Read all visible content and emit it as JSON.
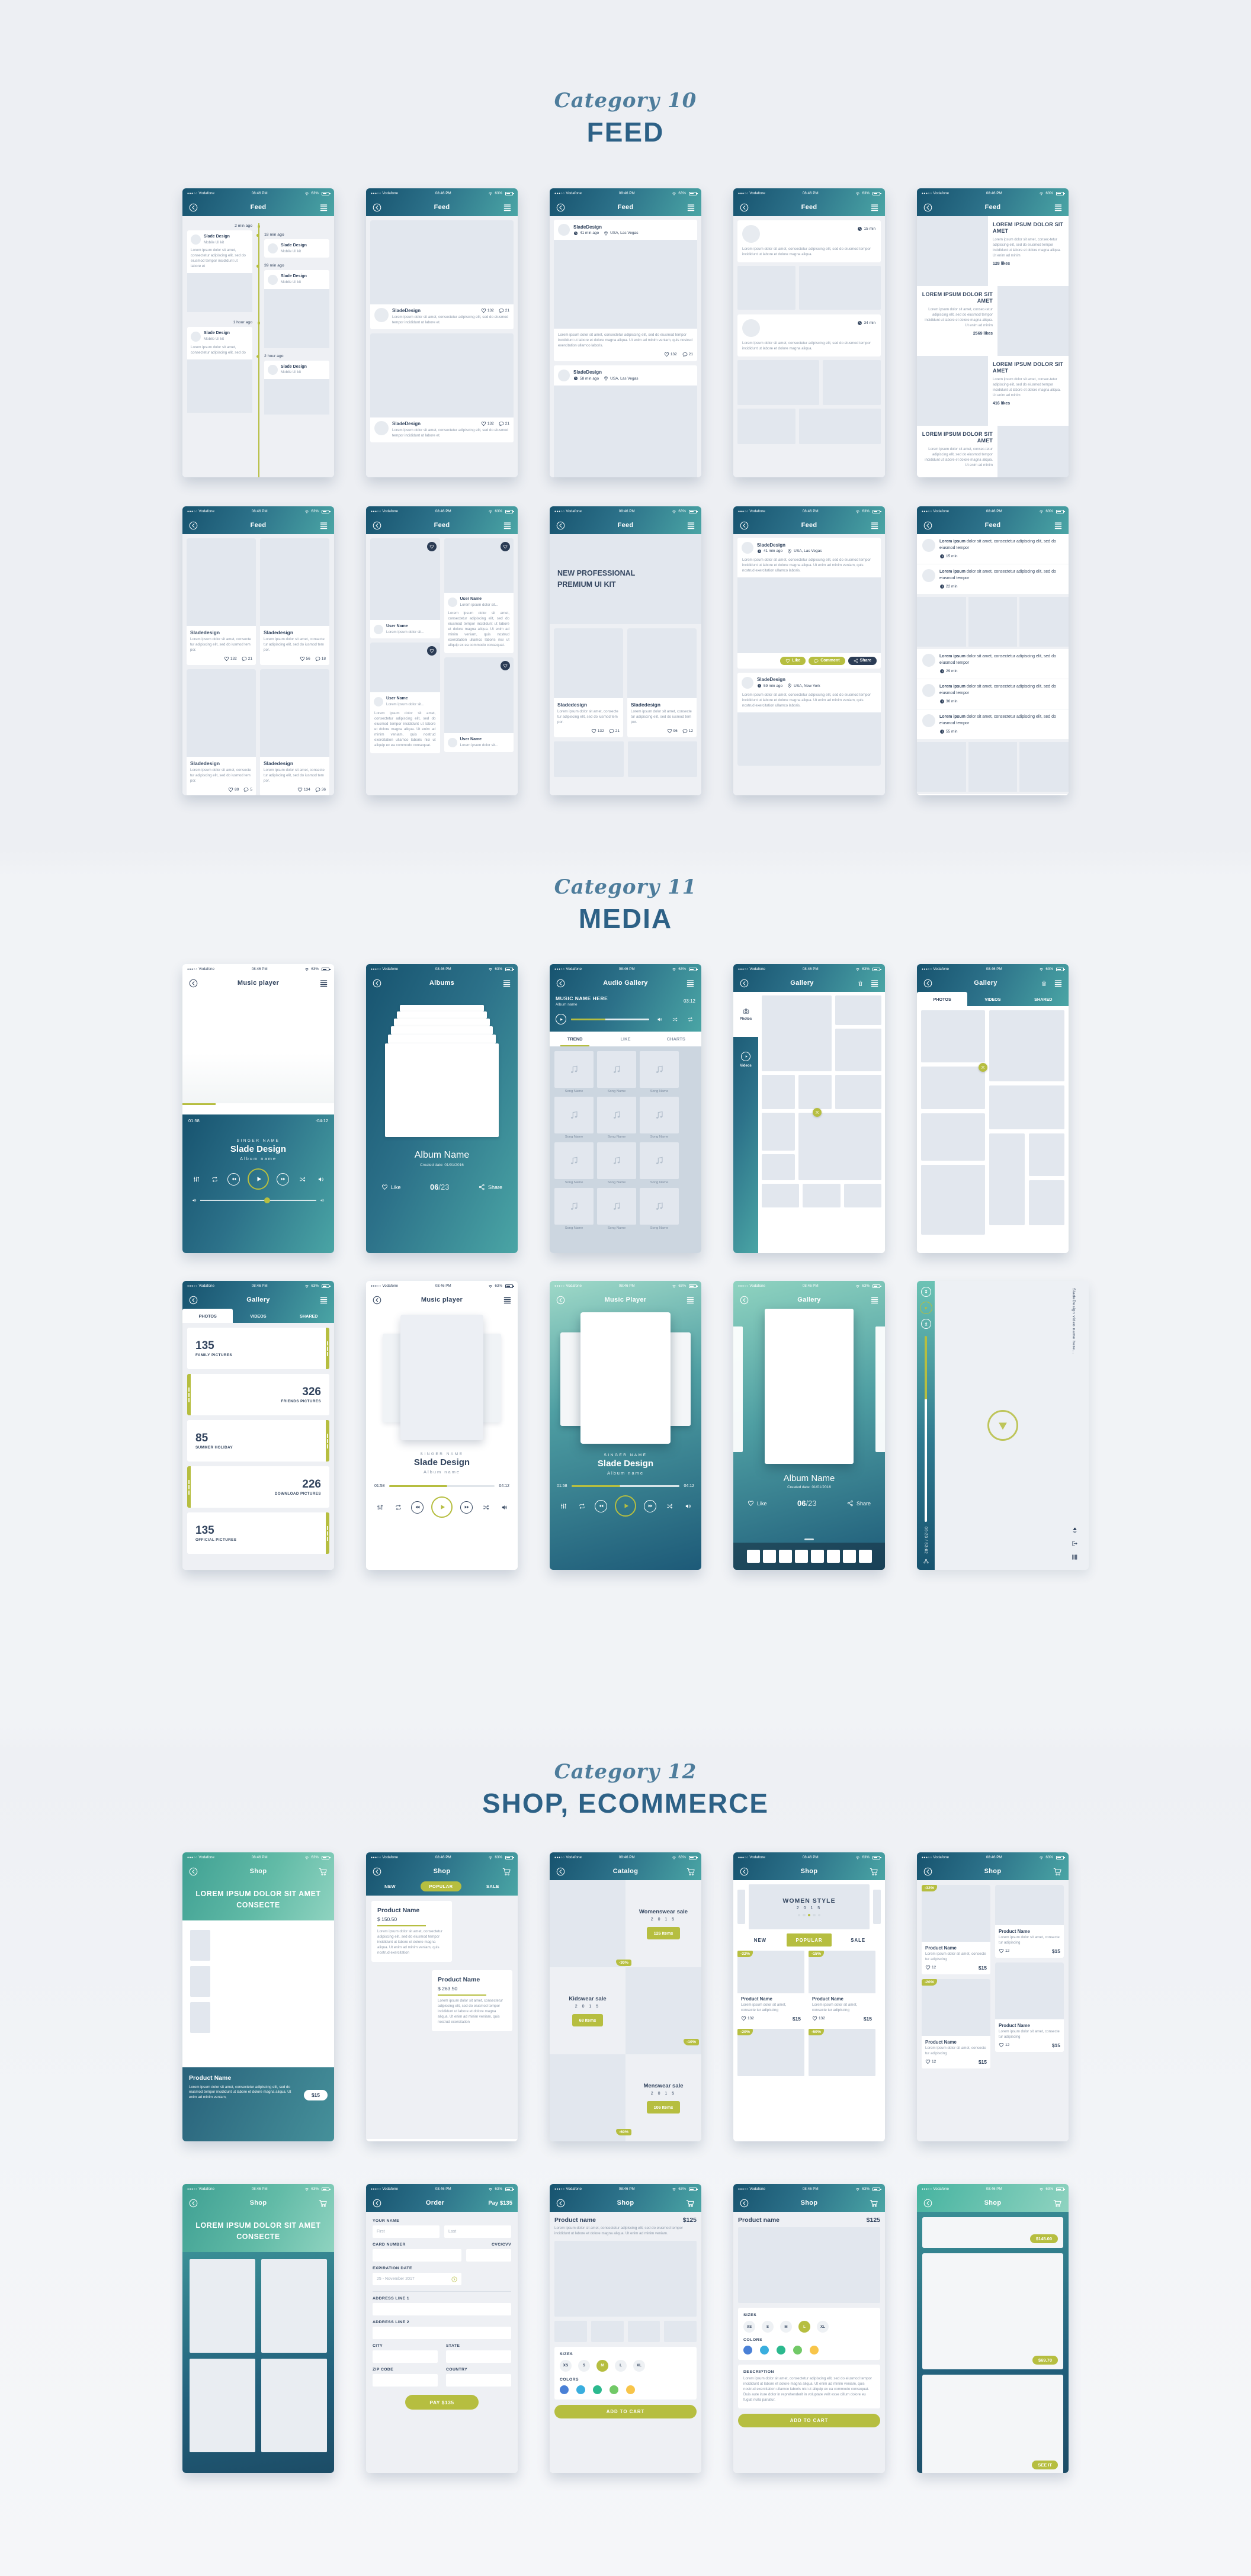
{
  "page": {
    "sections": [
      {
        "id": "feed",
        "category": "Category 10",
        "title": "FEED"
      },
      {
        "id": "media",
        "category": "Category 11",
        "title": "MEDIA"
      },
      {
        "id": "shop",
        "category": "Category 12",
        "title": "SHOP, ECOMMERCE"
      }
    ]
  },
  "palette": {
    "accent_olive": "#b6be40",
    "navy": "#32445e",
    "teal_dark": "#17536f",
    "teal_light": "#4aa5a5",
    "mint": "#8fd3c0",
    "heading_italic": "#4e7d9c",
    "heading_bold": "#2d6186"
  },
  "status": {
    "signal": "●●●○○",
    "carrier": "Vodafone",
    "time": "08:46 PM",
    "battery": "63%"
  },
  "icons": {
    "back": "chevron-left-circle",
    "menu": "hamburger-lines",
    "cart": "shopping-cart",
    "trash": "trash-can",
    "heart": "heart-outline",
    "comment": "speech-bubble",
    "clock": "clock-face",
    "location": "map-pin",
    "share": "share-nodes",
    "play": "play-triangle",
    "rewind": "rewind-triangles",
    "forward": "forward-triangles",
    "shuffle": "shuffle-arrows",
    "repeat": "repeat-loop",
    "volume": "speaker",
    "equalizer": "equalizer-sliders",
    "camera": "camera",
    "music-note": "eighth-note",
    "close": "x-mark",
    "wifi": "wifi-arcs",
    "battery": "battery-body",
    "chevron-right": "chevron-right-circle"
  },
  "feed": {
    "timeline": {
      "title": "Feed",
      "left": [
        {
          "time": "2 min ago",
          "name": "Slade Design",
          "sub": "Mobile UI kit",
          "text": "Lorem ipsum dolor sit amet, consectetur adipiscing elit, sed do eiusmod tempor incididunt ut labore et"
        },
        {
          "time": "1 hour ago",
          "name": "Slade Design",
          "sub": "Mobile UI kit",
          "text": "Lorem ipsum dolor sit amet, consectetur adipiscing elit, sed do"
        }
      ],
      "right": [
        {
          "time": "18 min ago",
          "name": "Slade Design",
          "sub": "Mobile UI kit"
        },
        {
          "time": "39 min ago",
          "name": "Slade Design",
          "sub": "Mobile UI kit"
        },
        {
          "time": "2 hour ago",
          "name": "Slade Design",
          "sub": "Mobile UI kit"
        }
      ]
    },
    "photo_cards": {
      "title": "Feed",
      "name": "SladeDesign",
      "text": "Lorem ipsum dolor sit amet, consectetur adipiscing elit, sed do eiusmod tempor incididunt ut labore et.",
      "cards": [
        {
          "likes": "132",
          "comments": "21"
        },
        {
          "likes": "132",
          "comments": "21"
        }
      ]
    },
    "posts": {
      "title": "Feed",
      "text": "Lorem ipsum dolor sit amet, consectetur adipiscing elit, sed do eiusmod tempor incididunt ut labore et dolore magna aliqua. Ut enim ad minim veniam, quis nostrud exercitation ullamco laboris.",
      "cards": [
        {
          "name": "SladeDesign",
          "time": "41 min ago",
          "location": "USA, Las Vegas",
          "likes": "132",
          "comments": "21"
        },
        {
          "name": "SladeDesign",
          "time": "58 min ago",
          "location": "USA, Las Vegas"
        }
      ]
    },
    "brief": {
      "title": "Feed",
      "cards": [
        {
          "time": "15 min",
          "text": "Lorem ipsum dolor sit amet, consectetur adipiscing elit, sed do eiusmod tempor incididunt ut labore et dolore magna aliqua."
        },
        {
          "time": "34 min",
          "text": "Lorem ipsum dolor sit amet, consectetur adipiscing elit, sed do eiusmod tempor incididunt ut labore et dolore magna aliqua."
        }
      ]
    },
    "articles": {
      "title": "Feed",
      "heading": "LOREM IPSUM DOLOR SIT AMET",
      "body": "Lorem ipsum dolor sit amet, consec-tetur adipiscing elit, sed do eiusmod tempor incididunt ut labore et dolore magna aliqua. Ut enim ad minim",
      "likes": [
        "128 likes",
        "2569 likes",
        "416 likes"
      ]
    },
    "grid": {
      "title": "Feed",
      "name": "Sladedesign",
      "text": "Lorem ipsum dolor sit amet, consecte tur adipiscing elit, sed do iusmod tem por.",
      "cells": [
        {
          "likes": "132",
          "comments": "21"
        },
        {
          "likes": "56",
          "comments": "18"
        },
        {
          "likes": "89",
          "comments": "5"
        },
        {
          "likes": "134",
          "comments": "36"
        }
      ]
    },
    "masonry": {
      "title": "Feed",
      "user": "User Name",
      "sub": "Lorem ipsum dolor sit...",
      "para": "Lorem ipsum dolor sit amet, consectetur adipiscing elit, sed do eiusmod tempor incididunt ut labore et dolore magna aliqua. Ut enim ad minim veniam, quis nostrud exercitation ullamco laboris nisi ut aliquip ex ea commodo consequat."
    },
    "hero_grid": {
      "title": "Feed",
      "hero": "NEW PROFESSIONAL PREMIUM UI KIT",
      "name": "Sladedesign",
      "text": "Lorem ipsum dolor sit amet, consecte tur adipiscing elit, sed do iusmod tem por.",
      "cells": [
        {
          "likes": "132",
          "comments": "21"
        },
        {
          "likes": "96",
          "comments": "12"
        }
      ]
    },
    "actions": {
      "title": "Feed",
      "like": "Like",
      "comment": "Comment",
      "share": "Share",
      "text": "Lorem ipsum dolor sit amet, consectetur adipiscing elit, sed do eiusmod tempor incididunt ut labore et dolore magna aliqua. Ut enim ad minim veniam, quis nostrud exercitation ullamco laboris.",
      "cards": [
        {
          "name": "SladeDesign",
          "time": "41 min ago",
          "location": "USA, Las Vegas"
        },
        {
          "name": "SladeDesign",
          "time": "59 min ago",
          "location": "USA, New York"
        }
      ]
    },
    "news": {
      "title": "Feed",
      "lead": "Lorem ipsum",
      "rest": "dolor sit amet, consectetur adipiscing elit, sed do eiusmod tempor",
      "items_top": [
        {
          "time": "15 min"
        },
        {
          "time": "22 min"
        }
      ],
      "items_bottom": [
        {
          "time": "29 min"
        },
        {
          "time": "36 min"
        },
        {
          "time": "55 min"
        }
      ]
    }
  },
  "media": {
    "player_light": {
      "title": "Music player",
      "elapsed": "01:58",
      "remaining": "-04:12",
      "singer_label": "SINGER NAME",
      "singer": "Slade Design",
      "album": "Album name"
    },
    "albums": {
      "title": "Albums",
      "album": "Album Name",
      "created": "Created date: 01/01/2016",
      "like": "Like",
      "index": "06",
      "total": "/23",
      "share": "Share"
    },
    "audio_gallery": {
      "title": "Audio Gallery",
      "music": "MUSIC NAME HERE",
      "album": "Album name",
      "duration": "03:12",
      "tabs": [
        {
          "label": "TREND",
          "cls": "on"
        },
        {
          "label": "LIKE",
          "cls": ""
        },
        {
          "label": "CHARTS",
          "cls": ""
        }
      ],
      "songs": [
        "Song Name",
        "Song Name",
        "Song Name",
        "Song Name",
        "Song Name",
        "Song Name",
        "Song Name",
        "Song Name",
        "Song Name",
        "Song Name",
        "Song Name",
        "Song Name"
      ]
    },
    "gallery_sidebar": {
      "title": "Gallery",
      "photos": "Photos",
      "videos": "Videos"
    },
    "gallery_tabs": {
      "title": "Gallery",
      "tabs": [
        {
          "label": "PHOTOS",
          "cls": "on"
        },
        {
          "label": "VIDEOS",
          "cls": ""
        },
        {
          "label": "SHARED",
          "cls": ""
        }
      ]
    },
    "albums_list": {
      "title": "Gallery",
      "tabs": [
        {
          "label": "PHOTOS",
          "cls": "on"
        },
        {
          "label": "VIDEOS",
          "cls": ""
        },
        {
          "label": "SHARED",
          "cls": ""
        }
      ],
      "items": [
        {
          "num": "135",
          "label": "FAMILY PICTURES",
          "side": "strip-r"
        },
        {
          "num": "326",
          "label": "FRIENDS PICTURES",
          "side": "strip-l"
        },
        {
          "num": "85",
          "label": "SUMMER HOLIDAY",
          "side": "strip-r"
        },
        {
          "num": "226",
          "label": "DOWNLOAD PICTURES",
          "side": "strip-l"
        },
        {
          "num": "135",
          "label": "OFFICIAL PICTURES",
          "side": "strip-r"
        }
      ]
    },
    "player_minimal": {
      "title": "Music player",
      "elapsed": "01:58",
      "duration": "04:12",
      "singer_label": "SINGER NAME",
      "singer": "Slade Design",
      "album": "Album name"
    },
    "player_gradient": {
      "title": "Music Player",
      "elapsed": "01:58",
      "duration": "04:12",
      "singer_label": "SINGER NAME",
      "singer": "Slade Design",
      "album": "Album name"
    },
    "gallery_carousel": {
      "title": "Gallery",
      "album": "Album Name",
      "created": "Created date: 01/01/2016",
      "like": "Like",
      "index": "06",
      "total": "/23",
      "share": "Share"
    },
    "video_player": {
      "name": "SladeDesign video name here...",
      "time": "09:23 / 53:02"
    }
  },
  "shop": {
    "product_hero": {
      "title": "Shop",
      "hero": "LOREM IPSUM DOLOR SIT AMET CONSECTE",
      "product": "Product Name",
      "text": "Lorem ipsum dolor sit amet, consectetur adipiscing elit, sed do eiusmod tempor incididunt ut labore et dolore magna aliqua. Ut enim ad minim veniam,",
      "price": "$15"
    },
    "popular": {
      "title": "Shop",
      "tab_new": "NEW",
      "tab_popular": "POPULAR",
      "tab_sale": "SALE",
      "text": "Lorem ipsum dolor sit amet, consectetur adipiscing elit, sed do eiusmod tempor incididunt ut labore et dolore magna aliqua. Ut enim ad minim veniam, quis nostrud exercitation",
      "products": [
        {
          "name": "Product Name",
          "price": "$ 150.50"
        },
        {
          "name": "Product Name",
          "price": "$ 263.50"
        }
      ]
    },
    "catalog": {
      "title": "Catalog",
      "rows": [
        {
          "name": "Womenswear sale",
          "year": "2 0 1 5",
          "items": "126 Items",
          "badge": "-30%"
        },
        {
          "name": "Kidswear sale",
          "year": "2 0 1 5",
          "items": "68 Items",
          "badge": "-10%"
        },
        {
          "name": "Menswear sale",
          "year": "2 0 1 5",
          "items": "106 Items",
          "badge": "-60%"
        }
      ]
    },
    "women_style": {
      "title": "Shop",
      "hero": "WOMEN STYLE",
      "year": "2 0 1 5",
      "tab_new": "NEW",
      "tab_popular": "POPULAR",
      "tab_sale": "SALE",
      "name": "Product Name",
      "snippet": "Lorem ipsum dolor sit amet, consecte tur adipiscing",
      "likes": "132",
      "price": "$15",
      "badges": [
        "-32%",
        "-15%",
        "-20%",
        "-50%"
      ]
    },
    "grid_badges": {
      "title": "Shop",
      "name": "Product Name",
      "snippet": "Lorem ipsum dolor sit amet, consecte tur adipiscing",
      "likes": "12",
      "price": "$15",
      "badges": [
        "-32%",
        "-20%"
      ]
    },
    "hero_tiles": {
      "title": "Shop",
      "hero": "LOREM IPSUM DOLOR SIT AMET CONSECTE"
    },
    "order": {
      "title": "Order",
      "pay_header": "Pay $135",
      "labels": {
        "your_name": "YOUR NAME",
        "card_number": "CARD NUMBER",
        "cvc": "CVC/CVV",
        "expiration": "EXPIRATION DATE",
        "address1": "ADDRESS LINE 1",
        "address2": "ADDRESS LINE 2",
        "city": "CITY",
        "state": "STATE",
        "zip": "ZIP CODE",
        "country": "COUNTRY"
      },
      "placeholders": {
        "first": "First",
        "last": "Last"
      },
      "expiration_value": "25 - November 2017",
      "pay_button": "PAY $135"
    },
    "detail_a": {
      "title": "Shop",
      "name": "Product name",
      "price": "$125",
      "text": "Lorem ipsum dolor sit amet, consectetur adipiscing elit, sed do eiusmod tempor incididunt ut labore et dolore magna aliqua. Ut enim ad minim veniam.",
      "sizes_label": "SIZES",
      "sizes": [
        {
          "v": "XS",
          "cls": ""
        },
        {
          "v": "S",
          "cls": ""
        },
        {
          "v": "M",
          "cls": "on"
        },
        {
          "v": "L",
          "cls": ""
        },
        {
          "v": "XL",
          "cls": ""
        }
      ],
      "colors_label": "COLORS",
      "colors": [
        "#4a80d6",
        "#3aaede",
        "#2cb98e",
        "#72c967",
        "#f8c54a"
      ],
      "button": "ADD TO CART"
    },
    "detail_b": {
      "title": "Shop",
      "name": "Product name",
      "price": "$125",
      "sizes_label": "SIZES",
      "sizes": [
        {
          "v": "XS",
          "cls": ""
        },
        {
          "v": "S",
          "cls": ""
        },
        {
          "v": "M",
          "cls": ""
        },
        {
          "v": "L",
          "cls": "on"
        },
        {
          "v": "XL",
          "cls": ""
        }
      ],
      "colors_label": "COLORS",
      "colors": [
        "#4a80d6",
        "#3aaede",
        "#2cb98e",
        "#72c967",
        "#f8c54a"
      ],
      "desc_label": "DESCRIPTION",
      "desc": "Lorem ipsum dolor sit amet, consectetur adipiscing elit, sed do eiusmod tempor incididunt ut labore et dolore magna aliqua. Ut enim ad minim veniam, quis nostrud exercitation ullamco laboris nisi ut aliquip ex ea commodo consequat. Duis aute irure dolor in reprehenderit in voluptate velit esse cillum dolore eu fugiat nulla pariatur.",
      "button": "ADD TO CART"
    },
    "price_cards": {
      "title": "Shop",
      "cards": [
        {
          "pill": "$145.00"
        },
        {
          "pill": "$69.70"
        },
        {
          "pill": "SEE IT"
        }
      ]
    }
  }
}
